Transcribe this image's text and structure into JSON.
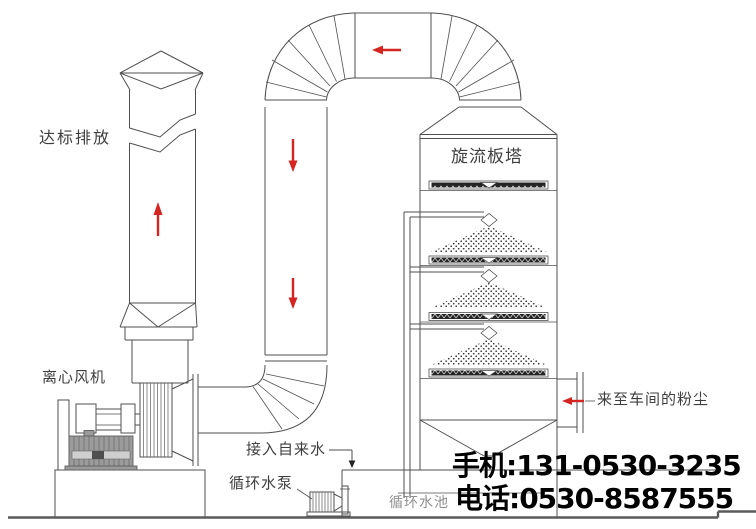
{
  "diagram_title": "cyclone-plate-tower-dust-scrubber-system",
  "colors": {
    "background": "#ffffff",
    "line": "#4f4f4f",
    "line_dark": "#333333",
    "arrow_red": "#d42521",
    "label_text": "#3e3e3e",
    "label_gray": "#8f8f8f",
    "phone_text": "#000000",
    "motor_fill": "#9b9b9b",
    "plate_fill": "#242424"
  },
  "labels": {
    "discharge": "达标排放",
    "fan": "离心风机",
    "tower": "旋流板塔",
    "inlet": "来至车间的粉尘",
    "tap_water": "接入自来水",
    "pump": "循环水泵",
    "pool": "循环水池"
  },
  "contact": {
    "mobile": "手机:131-0530-3235",
    "phone": "电话:0530-8587555"
  },
  "flow_arrows": [
    {
      "id": "stack-up-arrow",
      "direction": "up"
    },
    {
      "id": "top-duct-left-arrow",
      "direction": "left"
    },
    {
      "id": "downcomer-upper-arrow",
      "direction": "down"
    },
    {
      "id": "downcomer-lower-arrow",
      "direction": "down"
    },
    {
      "id": "inlet-left-arrow",
      "direction": "left"
    }
  ]
}
